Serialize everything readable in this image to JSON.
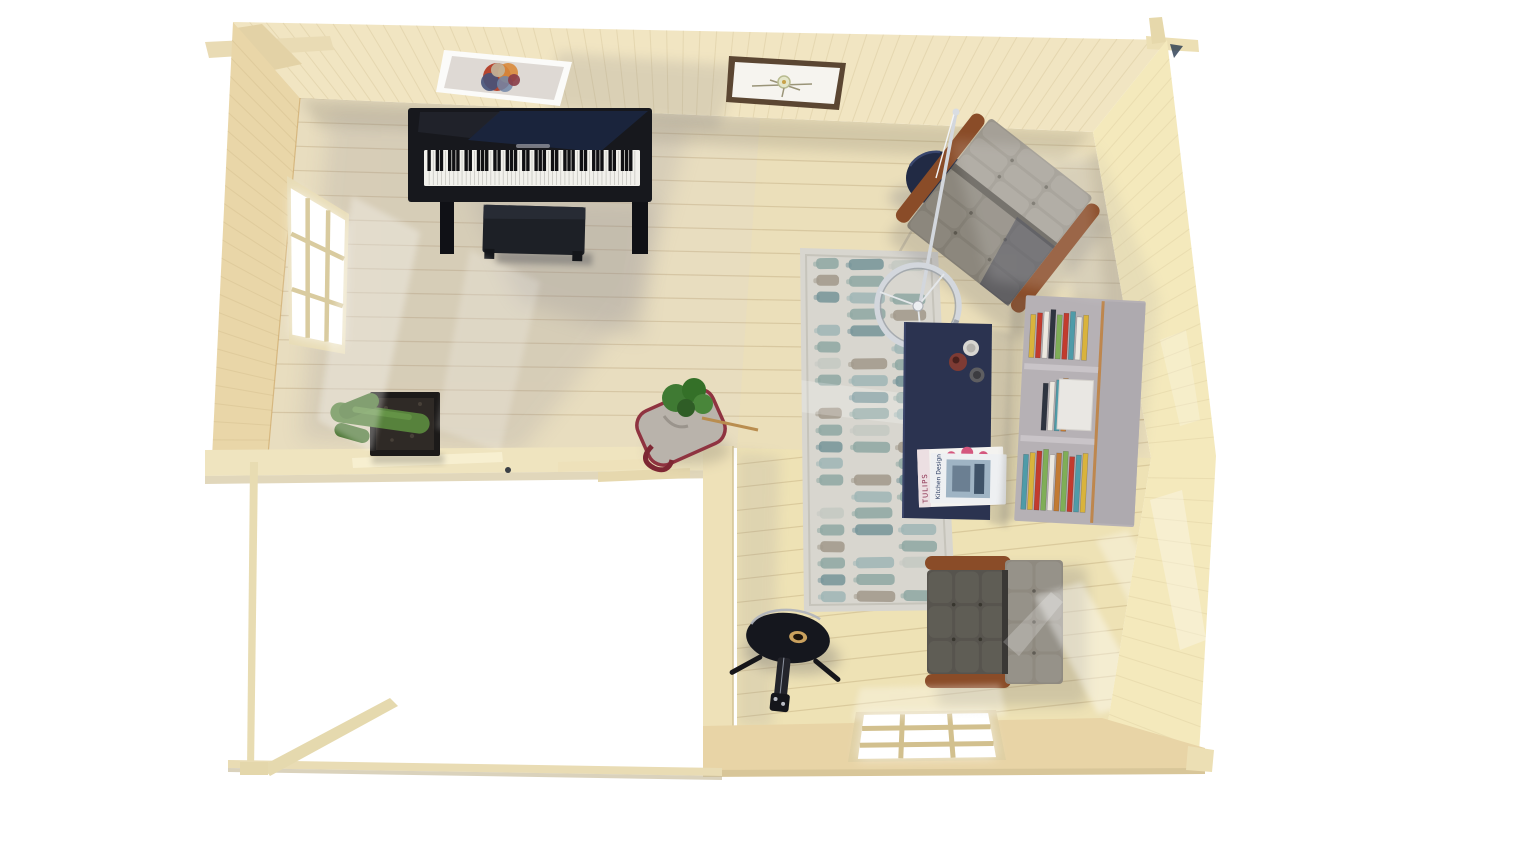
{
  "scene_label": "Top-down 3D render of a log cabin garden room interior",
  "palette": {
    "background": "#ffffff",
    "floor": "#ebdfba",
    "floor_plank_line": "rgba(160,133,84,0.25)",
    "wall_top": "#f1e5c2",
    "wall_left": "#e9d6a8",
    "wall_right": "#f4e9bc",
    "wall_bottom": "#e8d4a6",
    "wall_beam": "#efe4bf",
    "wall_partition": "#eee1b8",
    "window_glass": "#ffffff",
    "rug_base": "#d8d6cf",
    "piano_body": "#17181d",
    "piano_keys": "#f2f1ec",
    "bench": "#1d2026",
    "chair_dark": "#57544e",
    "chair_light": "#9b968c",
    "chair_wood": "#8a4c28",
    "table_navy": "#2b3350",
    "side_table_navy": "#212a44",
    "bookcase": "#b6b1b5",
    "bookcase_accent": "#c0803c",
    "lamp_chrome": "#d3d7dd",
    "cactus_green": "#57823c",
    "planter_black": "#1c1a19",
    "soil": "#2f2a26",
    "bag_gray": "#b9b3ab",
    "bag_trim_red": "#8f3340",
    "plant_green": "#3f7a33",
    "guitar_body": "#15171e",
    "guitar_hole": "#caa15e",
    "frame_white": "#fbfbf9",
    "frame_dark": "#5b4632"
  },
  "rug": {
    "colors": [
      "none",
      "#8fa9a4",
      "#9fb6b6",
      "#a29a8c",
      "#c4c9c3",
      "#77969a"
    ],
    "rows": [
      [
        1,
        5,
        4
      ],
      [
        3,
        1,
        0
      ],
      [
        5,
        2,
        1
      ],
      [
        0,
        1,
        3
      ],
      [
        2,
        5,
        0
      ],
      [
        1,
        0,
        2
      ],
      [
        4,
        3,
        1
      ],
      [
        1,
        2,
        5
      ],
      [
        0,
        5,
        1
      ],
      [
        3,
        1,
        2
      ],
      [
        1,
        4,
        0
      ],
      [
        5,
        1,
        3
      ],
      [
        2,
        0,
        1
      ],
      [
        1,
        3,
        5
      ],
      [
        0,
        2,
        1
      ],
      [
        4,
        1,
        0
      ],
      [
        1,
        5,
        2
      ],
      [
        3,
        0,
        1
      ],
      [
        1,
        2,
        4
      ],
      [
        5,
        1,
        0
      ],
      [
        2,
        3,
        1
      ]
    ]
  },
  "books": {
    "compartments": [
      [
        "#d9b33c",
        "#c23b2e",
        "#ece8e0",
        "#2e3440",
        "#7fae57",
        "#c23b2e",
        "#4f9ba8",
        "#ece8e0",
        "#d9b33c"
      ],
      [
        "#2e3440",
        "#ece8e0",
        "#4f9ba8",
        "#c27b33"
      ],
      [
        "#4f9ba8",
        "#d9b33c",
        "#c23b2e",
        "#7fae57",
        "#ece8e0",
        "#c27b33",
        "#7fae57",
        "#c23b2e",
        "#4f9ba8",
        "#d9b33c"
      ]
    ]
  },
  "piano": {
    "white_keys": 52
  },
  "magazines": {
    "bottom_title": "TULIPS",
    "top_title": "Kitchen Design"
  },
  "objects": {
    "piano": "upright digital piano",
    "piano_bench": "piano bench",
    "framed_art_abstract": "abstract art print, white frame",
    "framed_art_botanical": "botanical print, dark frame",
    "window_left": "nine-pane window, left wall",
    "window_bottom": "nine-pane window, bottom wall",
    "cactus": "cactus in square planter",
    "plant_bag": "plant in fabric tote",
    "rug": "striped area rug",
    "coffee_table": "navy coffee table",
    "side_table": "round navy side table",
    "arc_lamp": "chrome ring floor lamp",
    "lounge_chair_top": "tufted leather lounge chair (rotated)",
    "lounge_chair_bottom": "tufted leather lounge chair",
    "bookshelf": "gray bookcase with books",
    "guitar": "guitar on tripod stand"
  }
}
